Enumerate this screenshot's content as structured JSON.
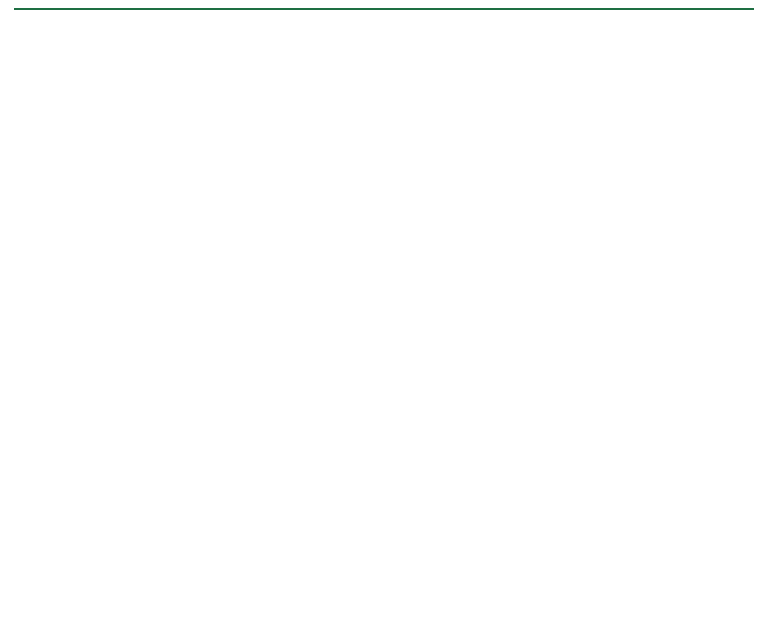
{
  "header": {
    "title": "Mesenbrink Development",
    "subtitle": "Mankato, Minnesota"
  },
  "map": {
    "colors": {
      "bg": "#fbfaf6",
      "road_label": "#E2402C",
      "lake_label": "#4a4a46",
      "magenta_fill": "#da8ade",
      "magenta_stroke": "#b23ab6",
      "magenta_inner": "#a93fae",
      "lot_number_white": "#ffffff",
      "green_number": "#2e8f2e",
      "green_halo": "#eef7e4",
      "salmon_fill": "#f2b9b0",
      "red_accent": "#d0443a",
      "yellow_boundary": "#FFE81C",
      "house_fill": "#e6e5e1",
      "house_stroke": "#55544f",
      "green_house_fill": "#d9edc4",
      "dot_magenta": "#ea7bea",
      "dot_green": "#a6d96a",
      "road_edge": "#a9a79f",
      "contour": "#8f8e86",
      "contour_line": "#cfccc3",
      "hatch_green": "#bcc2b0",
      "dark_line": "#6b6a64",
      "utility_blue": "#7b8fc0"
    },
    "north_box": {
      "north": "N",
      "horz": "HORZ",
      "scale": "SCALE",
      "feet": "FEET",
      "tick0": "0",
      "tick75": "75",
      "tick150": "150"
    },
    "margin_note": "H:\\ Revised PUD Plans - Concept",
    "lake_label": "UNNAMED LAKE",
    "road_labels": [
      {
        "text": "LUMA CIR",
        "x": 360,
        "y": 104,
        "rot": 0
      },
      {
        "text": "HOFFMAN RD",
        "x": 220,
        "y": 217,
        "rot": 0
      },
      {
        "text": "HAVEN PATH",
        "x": 470,
        "y": 196,
        "rot": -72
      },
      {
        "text": "SOLA CIR",
        "x": 578,
        "y": 201,
        "rot": -21
      },
      {
        "text": "MEADOW BEND TRL",
        "x": 362,
        "y": 307,
        "rot": 0
      },
      {
        "text": "VEY TRL",
        "x": 488,
        "y": 331,
        "rot": -13
      },
      {
        "text": "HAVEN PATH",
        "x": 415,
        "y": 377,
        "rot": -58
      },
      {
        "text": "MEADOW BEND TRL",
        "x": 549,
        "y": 425,
        "rot": -80
      },
      {
        "text": "MEADOW LIGHT DR",
        "x": 680,
        "y": 442,
        "rot": -73
      }
    ],
    "buildings": [
      {
        "name": "80 UNIT BUILDING",
        "elev": "ELEV = 1014.5"
      },
      {
        "name": "50 UNIT BUILDING",
        "elev": "ELEV = 1014.5"
      },
      {
        "name": "72 UNIT BUILDING",
        "elev": "ELEV = 1014.5"
      },
      {
        "name": "14 UNIT BUILDING",
        "elev": "ELEV = 1014.5"
      }
    ],
    "magenta_lots_small": [
      {
        "n": "1",
        "x": 414,
        "y": 269,
        "rot": -3
      },
      {
        "n": "2",
        "x": 388,
        "y": 268,
        "rot": 0
      },
      {
        "n": "3",
        "x": 362,
        "y": 268,
        "rot": 0
      },
      {
        "n": "4",
        "x": 334,
        "y": 265,
        "rot": -8
      },
      {
        "n": "5",
        "x": 297,
        "y": 270,
        "rot": -5
      },
      {
        "n": "6",
        "x": 273,
        "y": 290,
        "rot": -18
      },
      {
        "n": "7",
        "x": 267,
        "y": 318,
        "rot": 0
      },
      {
        "n": "8",
        "x": 267,
        "y": 344,
        "rot": 0
      }
    ],
    "magenta_blocks": [
      {
        "n": "28",
        "x": 322,
        "y": 320,
        "rot": 0
      },
      {
        "n": "29",
        "x": 322,
        "y": 349,
        "rot": 0
      },
      {
        "n": "30",
        "x": 321,
        "y": 376,
        "rot": 0
      },
      {
        "n": "31",
        "x": 323,
        "y": 403,
        "rot": 0
      },
      {
        "n": "32",
        "x": 322,
        "y": 430,
        "rot": 0
      },
      {
        "n": "33",
        "x": 321,
        "y": 456,
        "rot": 0
      },
      {
        "n": "34",
        "x": 321,
        "y": 483,
        "rot": 0
      },
      {
        "n": "27",
        "x": 563,
        "y": 394,
        "rot": -8
      },
      {
        "n": "26",
        "x": 552,
        "y": 422,
        "rot": -8
      }
    ],
    "green_lots_side": [
      {
        "n": "9",
        "x": 262,
        "y": 375,
        "rot": 0,
        "green_house": true
      },
      {
        "n": "10",
        "x": 263,
        "y": 403,
        "rot": 0
      },
      {
        "n": "11",
        "x": 260,
        "y": 431,
        "rot": 0
      },
      {
        "n": "12",
        "x": 261,
        "y": 459,
        "rot": 0
      },
      {
        "n": "13",
        "x": 262,
        "y": 489,
        "rot": 0
      },
      {
        "n": "23",
        "x": 529,
        "y": 512,
        "rot": 20
      },
      {
        "n": "24",
        "x": 538,
        "y": 481,
        "rot": 18
      },
      {
        "n": "25",
        "x": 544,
        "y": 450,
        "rot": 14
      }
    ],
    "green_lots_bottom": [
      {
        "n": "14",
        "x": 276,
        "y": 516,
        "rot": 24
      },
      {
        "n": "15",
        "x": 296,
        "y": 541,
        "rot": 8
      },
      {
        "n": "16",
        "x": 327,
        "y": 540,
        "rot": 4
      },
      {
        "n": "17",
        "x": 357,
        "y": 539,
        "rot": 2
      },
      {
        "n": "18",
        "x": 387,
        "y": 539,
        "rot": 0
      },
      {
        "n": "19",
        "x": 419,
        "y": 536,
        "rot": -2
      },
      {
        "n": "20",
        "x": 449,
        "y": 534,
        "rot": -4
      },
      {
        "n": "21",
        "x": 475,
        "y": 532,
        "rot": -8
      },
      {
        "n": "22",
        "x": 505,
        "y": 528,
        "rot": -14
      }
    ],
    "houses": [
      [
        258,
        82,
        -15,
        0
      ],
      [
        296,
        74,
        5,
        0
      ],
      [
        336,
        70,
        -5,
        0
      ],
      [
        372,
        77,
        12,
        0
      ],
      [
        410,
        70,
        -8,
        0
      ],
      [
        447,
        76,
        8,
        0
      ],
      [
        482,
        88,
        -12,
        0
      ],
      [
        516,
        97,
        15,
        0
      ],
      [
        549,
        107,
        -5,
        0
      ],
      [
        207,
        160,
        10,
        0
      ],
      [
        243,
        170,
        -8,
        0
      ],
      [
        283,
        177,
        4,
        0
      ],
      [
        322,
        166,
        14,
        0
      ],
      [
        360,
        157,
        -12,
        0
      ],
      [
        398,
        149,
        18,
        0
      ],
      [
        434,
        141,
        -4,
        0
      ],
      [
        468,
        131,
        -18,
        0
      ],
      [
        503,
        127,
        25,
        0
      ],
      [
        537,
        139,
        8,
        0
      ],
      [
        570,
        152,
        -14,
        0
      ],
      [
        604,
        167,
        6,
        0
      ],
      [
        637,
        181,
        18,
        0
      ],
      [
        669,
        177,
        -8,
        0
      ],
      [
        701,
        168,
        4,
        0
      ],
      [
        733,
        184,
        12,
        0
      ],
      [
        489,
        203,
        -18,
        0
      ],
      [
        523,
        217,
        8,
        0
      ],
      [
        558,
        231,
        -6,
        0
      ],
      [
        592,
        227,
        12,
        0
      ],
      [
        626,
        241,
        -10,
        0
      ],
      [
        661,
        252,
        14,
        0
      ],
      [
        695,
        247,
        -4,
        0
      ],
      [
        729,
        236,
        8,
        0
      ],
      [
        651,
        210,
        -15,
        0
      ],
      [
        746,
        262,
        8,
        0
      ],
      [
        737,
        290,
        -8,
        0
      ],
      [
        556,
        282,
        6,
        0
      ],
      [
        588,
        292,
        -8,
        0
      ],
      [
        617,
        303,
        10,
        0
      ],
      [
        647,
        316,
        -6,
        0
      ],
      [
        677,
        329,
        8,
        0
      ],
      [
        706,
        341,
        -10,
        0
      ],
      [
        458,
        299,
        -8,
        1
      ],
      [
        484,
        296,
        6,
        1
      ],
      [
        512,
        314,
        -14,
        1
      ],
      [
        534,
        323,
        10,
        1
      ],
      [
        455,
        352,
        4,
        1
      ],
      [
        396,
        330,
        8,
        1
      ],
      [
        398,
        354,
        -4,
        1
      ],
      [
        388,
        376,
        6,
        1
      ],
      [
        379,
        402,
        -8,
        1
      ],
      [
        381,
        429,
        4,
        1
      ],
      [
        374,
        458,
        -6,
        1
      ],
      [
        379,
        483,
        8,
        1
      ],
      [
        432,
        380,
        -10,
        1
      ],
      [
        509,
        370,
        6,
        1
      ],
      [
        501,
        392,
        -8,
        1
      ],
      [
        583,
        346,
        10,
        1
      ],
      [
        607,
        353,
        -6,
        1
      ],
      [
        634,
        356,
        4,
        1
      ],
      [
        663,
        359,
        -12,
        1
      ],
      [
        594,
        412,
        6,
        1
      ],
      [
        626,
        415,
        -8,
        1
      ],
      [
        694,
        368,
        -10,
        2
      ],
      [
        711,
        399,
        8,
        2
      ],
      [
        714,
        428,
        -6,
        2
      ],
      [
        716,
        448,
        10,
        2
      ],
      [
        629,
        457,
        -8,
        2
      ],
      [
        643,
        486,
        6,
        2
      ],
      [
        678,
        498,
        -10,
        2
      ],
      [
        704,
        484,
        8,
        2
      ],
      [
        653,
        423,
        -4,
        2
      ]
    ],
    "boundary_points": [
      [
        222,
        313
      ],
      [
        330,
        362
      ],
      [
        400,
        385
      ],
      [
        470,
        400
      ],
      [
        500,
        408
      ],
      [
        540,
        419
      ],
      [
        552,
        421
      ],
      [
        570,
        416
      ],
      [
        585,
        412
      ],
      [
        737,
        412
      ],
      [
        737,
        517
      ],
      [
        583,
        517
      ],
      [
        583,
        568
      ],
      [
        218,
        570
      ],
      [
        218,
        318
      ],
      [
        222,
        313
      ]
    ],
    "contour_labels": [
      [
        555,
        80,
        "1003",
        -8
      ],
      [
        648,
        92,
        "1013",
        -20
      ],
      [
        640,
        108,
        "1003",
        -5
      ],
      [
        655,
        132,
        "1008",
        0
      ],
      [
        660,
        150,
        "1013",
        0
      ],
      [
        607,
        167,
        "1015",
        -10
      ],
      [
        608,
        176,
        "1016",
        -10
      ],
      [
        533,
        118,
        "1013",
        -40
      ],
      [
        700,
        155,
        "1013",
        -15
      ],
      [
        58,
        163,
        "1003",
        0
      ],
      [
        76,
        172,
        "1015",
        0
      ],
      [
        48,
        188,
        "1010",
        0
      ],
      [
        160,
        192,
        "1013",
        -5
      ],
      [
        48,
        220,
        "1013",
        -35
      ],
      [
        362,
        229,
        "1013",
        -8
      ],
      [
        43,
        295,
        "1009",
        0
      ],
      [
        23,
        323,
        "1012",
        0
      ],
      [
        67,
        323,
        "1012",
        0
      ],
      [
        46,
        343,
        "1013",
        0
      ],
      [
        20,
        380,
        "1014",
        0
      ],
      [
        132,
        323,
        "1012",
        -3
      ],
      [
        88,
        355,
        "1013",
        -30
      ],
      [
        71,
        420,
        "1014",
        -60
      ],
      [
        105,
        500,
        "1013",
        -40
      ],
      [
        98,
        565,
        "1014",
        -25
      ],
      [
        75,
        575,
        "1013",
        0
      ],
      [
        328,
        553,
        "1025",
        -10
      ],
      [
        330,
        562,
        "1024",
        -8
      ],
      [
        482,
        550,
        "1025",
        0
      ],
      [
        479,
        558,
        "1024",
        0
      ],
      [
        480,
        566,
        "1023",
        0
      ],
      [
        716,
        493,
        "1016",
        -70
      ],
      [
        719,
        502,
        "1015",
        -70
      ],
      [
        722,
        511,
        "1014",
        -70
      ]
    ]
  }
}
